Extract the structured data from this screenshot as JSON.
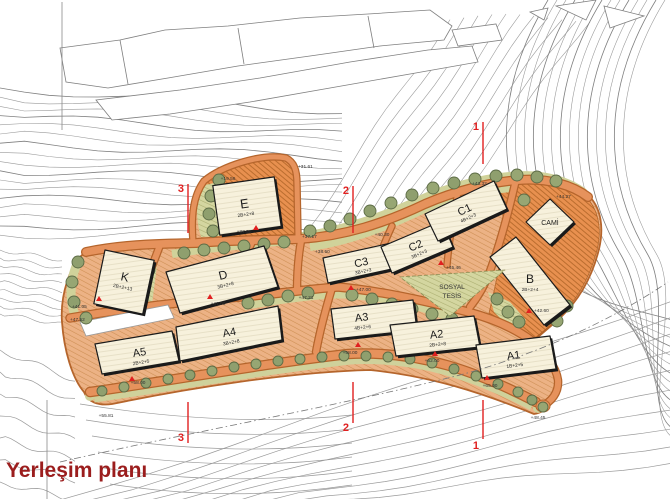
{
  "title": "Yerleşim planı",
  "buildings": [
    {
      "id": "E",
      "label": "E",
      "sub": "2B+2+8"
    },
    {
      "id": "K",
      "label": "K",
      "sub": "2B+2+13"
    },
    {
      "id": "D",
      "label": "D",
      "sub": "3B+2+8"
    },
    {
      "id": "A5",
      "label": "A5",
      "sub": "2B+2+5"
    },
    {
      "id": "A4",
      "label": "A4",
      "sub": "3B+2+8"
    },
    {
      "id": "A3",
      "label": "A3",
      "sub": "4B+2+6"
    },
    {
      "id": "A2",
      "label": "A2",
      "sub": "2B+2+8"
    },
    {
      "id": "A1",
      "label": "A1",
      "sub": "1B+2+5"
    },
    {
      "id": "C3",
      "label": "C3",
      "sub": "3B+2+3"
    },
    {
      "id": "C2",
      "label": "C2",
      "sub": "3B+2+3"
    },
    {
      "id": "C1",
      "label": "C1",
      "sub": "4B+2+3"
    },
    {
      "id": "B",
      "label": "B",
      "sub": "2B+2+4"
    },
    {
      "id": "CAMI",
      "label": "CAMİ",
      "sub": ""
    },
    {
      "id": "SOSYAL_TESIS",
      "label": "SOSYAL",
      "sub": "TESİS"
    }
  ],
  "sections": {
    "one": "1",
    "two": "2",
    "three": "3"
  },
  "levels": [
    "+31.61",
    "+19.56",
    "+37.50",
    "+37.17",
    "+38.50",
    "+40.30",
    "+43.32",
    "+44.27",
    "+45.46",
    "+47.00",
    "+47.21",
    "+41.05",
    "+47.52",
    "+58.00",
    "+58.00",
    "+62.00",
    "+65.00",
    "+48.45",
    "+55.81",
    "+42.60",
    "+47.00"
  ],
  "colors": {
    "road": "#e6925c",
    "slope": "#e8904f",
    "green": "#d4d6a0",
    "building": "#f7f1dc",
    "red": "#e02020",
    "title": "#9b1d1d",
    "contour": "#9a9a9a"
  }
}
